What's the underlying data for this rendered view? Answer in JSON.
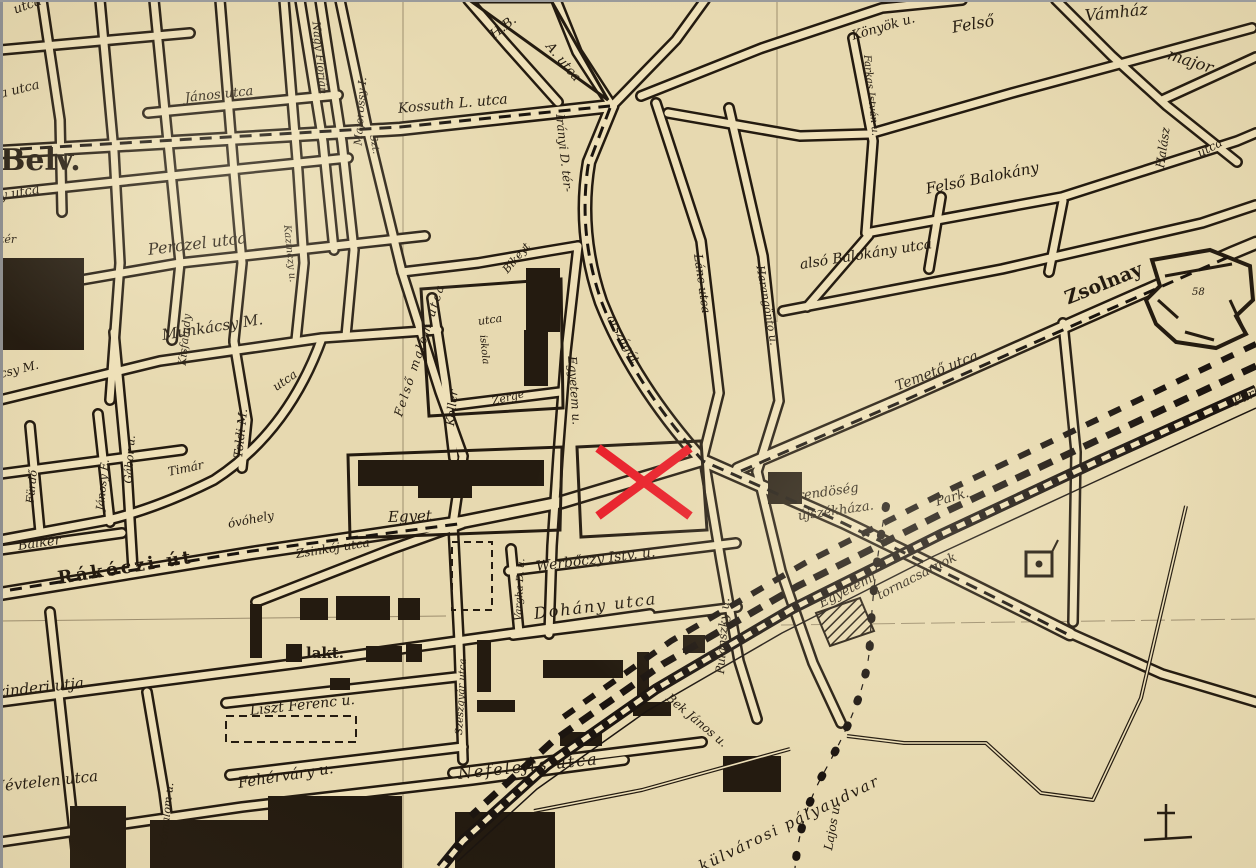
{
  "map": {
    "kind": "scanned-street-map",
    "colors": {
      "paper": "#e7d9b0",
      "street_fill": "#eee0b8",
      "ink": "#241b10",
      "marker_red": "#e81b26",
      "grid_line": "#7e6e53"
    },
    "marker": {
      "shape": "x-cross",
      "x1": 598,
      "y1": 448,
      "x2": 690,
      "y2": 516,
      "stroke": 9,
      "color": "#e81b26"
    },
    "labels": [
      {
        "t": "utca",
        "x": 14,
        "y": 4,
        "r": -20,
        "s": 13
      },
      {
        "t": "a utca",
        "x": 0,
        "y": 88,
        "r": -14,
        "s": 13
      },
      {
        "t": "Belv.",
        "x": 0,
        "y": 146,
        "r": 0,
        "s": 30,
        "b": 1
      },
      {
        "t": "y utca",
        "x": 0,
        "y": 190,
        "r": -10,
        "s": 13
      },
      {
        "t": "tér",
        "x": 0,
        "y": 234,
        "r": 0,
        "s": 11
      },
      {
        "t": "János utca",
        "x": 185,
        "y": 92,
        "r": -6,
        "s": 13
      },
      {
        "t": "Nagy Flórián",
        "x": 316,
        "y": 16,
        "r": 84,
        "s": 11
      },
      {
        "t": "Majorossy I.",
        "x": 358,
        "y": 140,
        "r": -86,
        "s": 11
      },
      {
        "t": "Szt.",
        "x": 372,
        "y": 130,
        "r": 80,
        "s": 10
      },
      {
        "t": "Perczel utca",
        "x": 148,
        "y": 242,
        "r": -7,
        "s": 16
      },
      {
        "t": "Kazinczy u.",
        "x": 286,
        "y": 220,
        "r": 84,
        "s": 10
      },
      {
        "t": "Munkácsy M.",
        "x": 162,
        "y": 328,
        "r": -9,
        "s": 15
      },
      {
        "t": "csy M.",
        "x": 0,
        "y": 368,
        "r": -14,
        "s": 12
      },
      {
        "t": "Kisfaludy",
        "x": 182,
        "y": 360,
        "r": -84,
        "s": 11
      },
      {
        "t": "Fürdő",
        "x": 30,
        "y": 498,
        "r": -84,
        "s": 11
      },
      {
        "t": "Jánosy E.",
        "x": 100,
        "y": 505,
        "r": -84,
        "s": 11
      },
      {
        "t": "Gábor u.",
        "x": 128,
        "y": 478,
        "r": -86,
        "s": 11
      },
      {
        "t": "Timár",
        "x": 168,
        "y": 466,
        "r": -12,
        "s": 12
      },
      {
        "t": "Toldi M.",
        "x": 238,
        "y": 452,
        "r": -84,
        "s": 12
      },
      {
        "t": "utca",
        "x": 274,
        "y": 382,
        "r": -35,
        "s": 12
      },
      {
        "t": "Felső malom utca",
        "x": 398,
        "y": 410,
        "r": -72,
        "s": 12,
        "ls": 2
      },
      {
        "t": "Koller",
        "x": 450,
        "y": 420,
        "r": -84,
        "s": 12
      },
      {
        "t": "utca",
        "x": 478,
        "y": 316,
        "r": -8,
        "s": 11
      },
      {
        "t": "iskola",
        "x": 482,
        "y": 330,
        "r": 84,
        "s": 10
      },
      {
        "t": "Zerge",
        "x": 492,
        "y": 396,
        "r": -14,
        "s": 11
      },
      {
        "t": "Bikeyt",
        "x": 505,
        "y": 266,
        "r": -50,
        "s": 11
      },
      {
        "t": "Kossuth L. utca",
        "x": 398,
        "y": 102,
        "r": -5,
        "s": 14
      },
      {
        "t": "H.B.",
        "x": 492,
        "y": 30,
        "r": -38,
        "s": 13
      },
      {
        "t": "A. utca",
        "x": 548,
        "y": 38,
        "r": 50,
        "s": 13
      },
      {
        "t": "Irányi D. tér-",
        "x": 560,
        "y": 108,
        "r": 84,
        "s": 12
      },
      {
        "t": "országút",
        "x": 610,
        "y": 310,
        "r": 60,
        "s": 12
      },
      {
        "t": "Lánc utca",
        "x": 698,
        "y": 248,
        "r": 82,
        "s": 12
      },
      {
        "t": "Harangöntő u.",
        "x": 760,
        "y": 260,
        "r": 80,
        "s": 11
      },
      {
        "t": "Könyök u.",
        "x": 852,
        "y": 30,
        "r": -16,
        "s": 13
      },
      {
        "t": "Felső",
        "x": 952,
        "y": 20,
        "r": -10,
        "s": 16
      },
      {
        "t": "Vámház",
        "x": 1085,
        "y": 8,
        "r": -6,
        "s": 16
      },
      {
        "t": "major",
        "x": 1168,
        "y": 46,
        "r": 18,
        "s": 16
      },
      {
        "t": "Halász",
        "x": 1160,
        "y": 162,
        "r": -82,
        "s": 12
      },
      {
        "t": "utca",
        "x": 1198,
        "y": 148,
        "r": -28,
        "s": 12
      },
      {
        "t": "Farkas István u.",
        "x": 866,
        "y": 50,
        "r": 84,
        "s": 10
      },
      {
        "t": "Felső Balokány",
        "x": 926,
        "y": 182,
        "r": -11,
        "s": 15
      },
      {
        "t": "alsó Balokány utca",
        "x": 800,
        "y": 258,
        "r": -9,
        "s": 14
      },
      {
        "t": "Zsolnay",
        "x": 1066,
        "y": 290,
        "r": -22,
        "s": 19,
        "b": 1
      },
      {
        "t": "58",
        "x": 1192,
        "y": 288,
        "r": 0,
        "s": 10
      },
      {
        "t": "Temető utca",
        "x": 896,
        "y": 380,
        "r": -21,
        "s": 14
      },
      {
        "t": "Park",
        "x": 1234,
        "y": 396,
        "r": -24,
        "s": 13
      },
      {
        "t": "Rákóczi út",
        "x": 58,
        "y": 570,
        "r": -9,
        "s": 18,
        "b": 1,
        "ls": 3
      },
      {
        "t": "óvóhely",
        "x": 228,
        "y": 518,
        "r": -11,
        "s": 12
      },
      {
        "t": "Zsinkój utca",
        "x": 296,
        "y": 548,
        "r": -9,
        "s": 12
      },
      {
        "t": "Czinderi utja",
        "x": -14,
        "y": 686,
        "r": -6,
        "s": 15
      },
      {
        "t": "Névtelen utca",
        "x": -8,
        "y": 780,
        "r": -6,
        "s": 15
      },
      {
        "t": "Balkér",
        "x": 18,
        "y": 540,
        "r": -8,
        "s": 13
      },
      {
        "t": "lakt.",
        "x": 306,
        "y": 646,
        "r": 0,
        "s": 15,
        "b": 1
      },
      {
        "t": "Liszt Ferenc u.",
        "x": 250,
        "y": 704,
        "r": -6,
        "s": 14
      },
      {
        "t": "Fehérváry u.",
        "x": 238,
        "y": 776,
        "r": -9,
        "s": 15
      },
      {
        "t": "Alsómalom u.",
        "x": 162,
        "y": 852,
        "r": -84,
        "s": 11
      },
      {
        "t": "Szeszgyár utca",
        "x": 460,
        "y": 730,
        "r": -87,
        "s": 10
      },
      {
        "t": "Vargha D. u.",
        "x": 519,
        "y": 616,
        "r": -87,
        "s": 10
      },
      {
        "t": "Egyet.",
        "x": 388,
        "y": 510,
        "r": -2,
        "s": 15
      },
      {
        "t": "Egyetem u.",
        "x": 572,
        "y": 350,
        "r": 86,
        "s": 12
      },
      {
        "t": "Werbőczy Istv. u.",
        "x": 536,
        "y": 560,
        "r": -7,
        "s": 14
      },
      {
        "t": "Dohány utca",
        "x": 534,
        "y": 606,
        "r": -7,
        "s": 16,
        "ls": 2
      },
      {
        "t": "Nefelejts utca",
        "x": 458,
        "y": 766,
        "r": -6,
        "s": 16,
        "ls": 2
      },
      {
        "t": "Pulánszky u.",
        "x": 720,
        "y": 668,
        "r": -86,
        "s": 12
      },
      {
        "t": "rendöség",
        "x": 798,
        "y": 490,
        "r": -8,
        "s": 13
      },
      {
        "t": "újszékháza.",
        "x": 798,
        "y": 510,
        "r": -8,
        "s": 13
      },
      {
        "t": "Park.",
        "x": 936,
        "y": 496,
        "r": -16,
        "s": 13
      },
      {
        "t": "Egyetemi",
        "x": 820,
        "y": 598,
        "r": -27,
        "s": 13
      },
      {
        "t": "tornacsarnok",
        "x": 878,
        "y": 590,
        "r": -27,
        "s": 13
      },
      {
        "t": "Bek János u.",
        "x": 668,
        "y": 690,
        "r": 40,
        "s": 12
      },
      {
        "t": "Lajos u.",
        "x": 828,
        "y": 844,
        "r": -80,
        "s": 12
      },
      {
        "t": "külvárosi pályaudvar",
        "x": 700,
        "y": 860,
        "r": -26,
        "s": 15,
        "ls": 2
      }
    ]
  }
}
